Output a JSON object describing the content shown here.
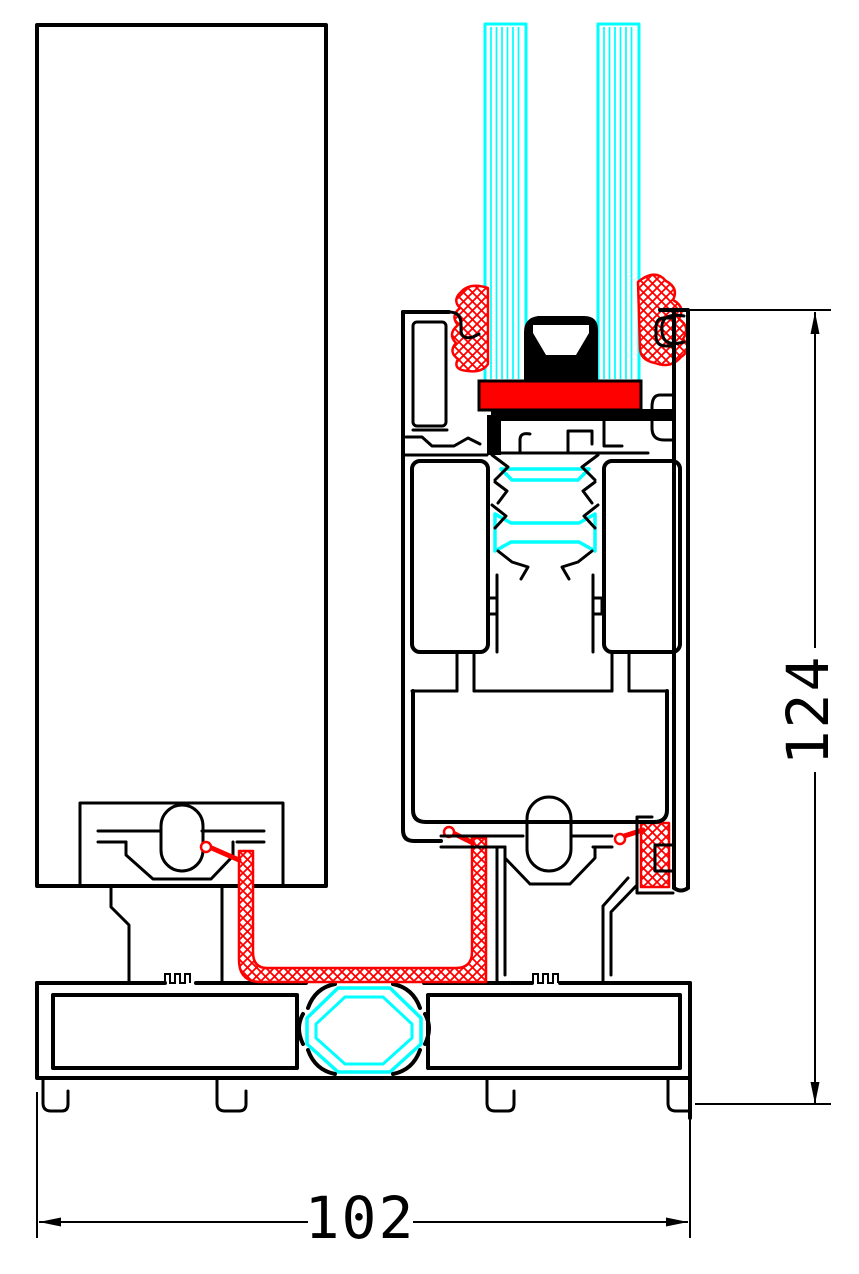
{
  "drawing": {
    "kind": "aluminium-profile-cross-section",
    "dimensions": {
      "height": {
        "value": "124"
      },
      "width": {
        "value": "102"
      }
    },
    "colors": {
      "outline": "#000000",
      "glass": "#00ffff",
      "thermal_break": "#00ffff",
      "gasket": "#ff0000",
      "setting_block": "#ff0000",
      "background": "#ffffff"
    },
    "components": {
      "panel": "fixed-panel",
      "glazing": "double-glazing-unit",
      "sash": "sash-profile",
      "sill": "sill-profile"
    }
  }
}
